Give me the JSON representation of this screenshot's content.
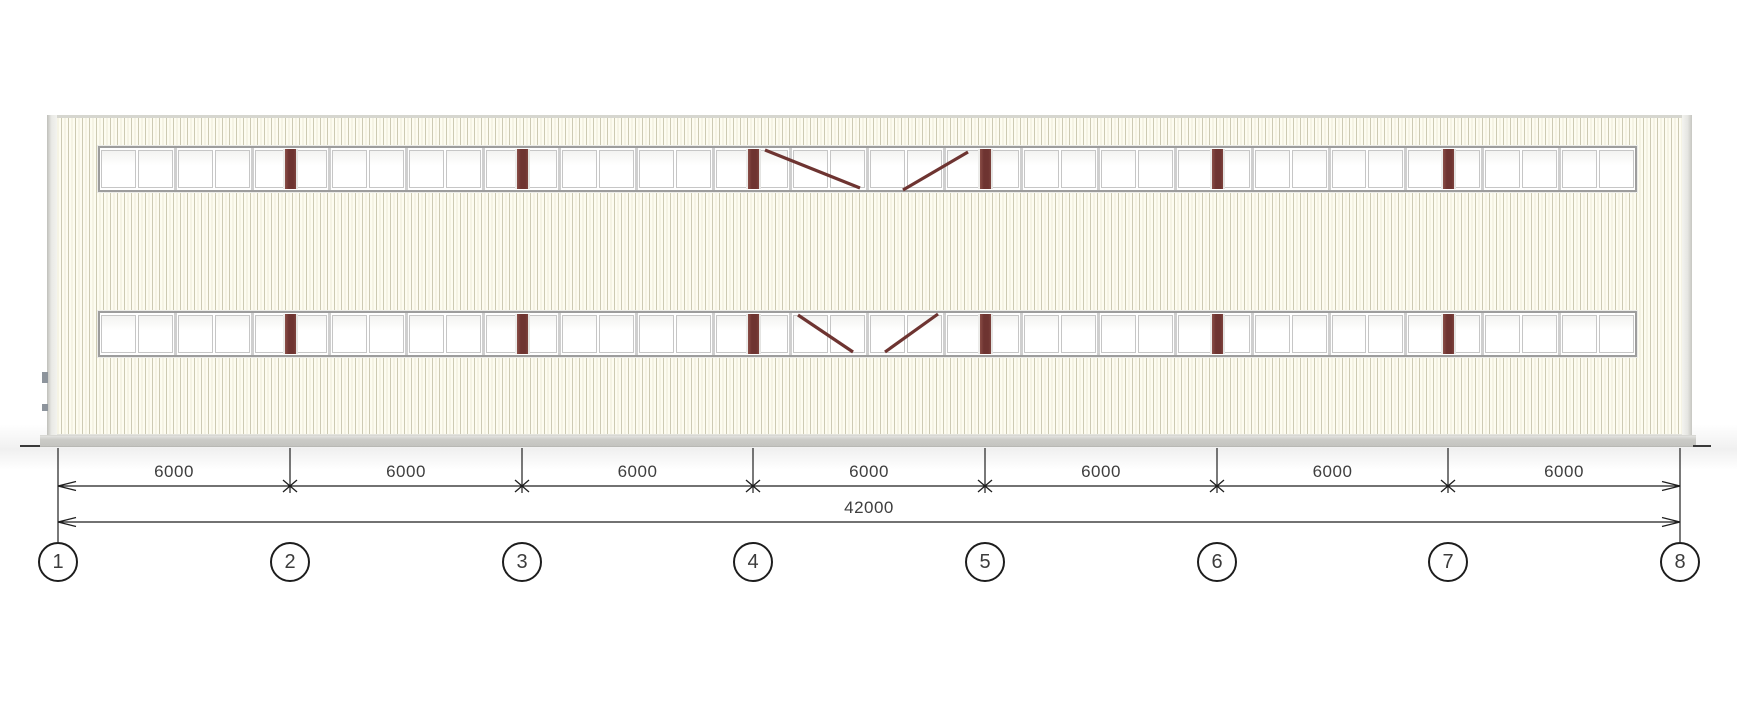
{
  "drawing": {
    "kind": "building-elevation",
    "grid_axes": [
      "1",
      "2",
      "3",
      "4",
      "5",
      "6",
      "7",
      "8"
    ],
    "dimensions": {
      "bays": [
        "6000",
        "6000",
        "6000",
        "6000",
        "6000",
        "6000",
        "6000"
      ],
      "total": "42000"
    },
    "colors": {
      "siding_field": "#fdfcf1",
      "siding_stripe": "#cdcab3",
      "column_maroon": "#6e3431",
      "plinth_gray": "#c9c9c5",
      "window_frame": "#9d9d9d",
      "dim_line": "#1f1f1f",
      "dim_text": "#3e3e3e"
    },
    "geometry": {
      "grid_x": [
        58,
        290,
        522,
        753,
        985,
        1217,
        1448,
        1680
      ],
      "band_left": 98,
      "band_width": 1539,
      "bands_top": [
        146,
        311
      ],
      "band_height": 46,
      "units_per_band": 20,
      "column_grid_indices": [
        1,
        2,
        3,
        4,
        5,
        6
      ],
      "braces": [
        {
          "x1": 765,
          "y1": 150,
          "x2": 860,
          "y2": 188
        },
        {
          "x1": 903,
          "y1": 190,
          "x2": 968,
          "y2": 152
        },
        {
          "x1": 798,
          "y1": 315,
          "x2": 853,
          "y2": 352
        },
        {
          "x1": 885,
          "y1": 352,
          "x2": 938,
          "y2": 314
        }
      ],
      "dim_line1_y": 486,
      "dim_line2_y": 522,
      "ext_top": 448,
      "ext_short_bottom": 493,
      "ext_long_bottom": 542,
      "bay_label_top": 462,
      "total_label_top": 498,
      "bubble_top": 542,
      "ground_dashes": [
        {
          "x": 20,
          "w": 20
        },
        {
          "x": 1693,
          "w": 18
        }
      ]
    }
  }
}
